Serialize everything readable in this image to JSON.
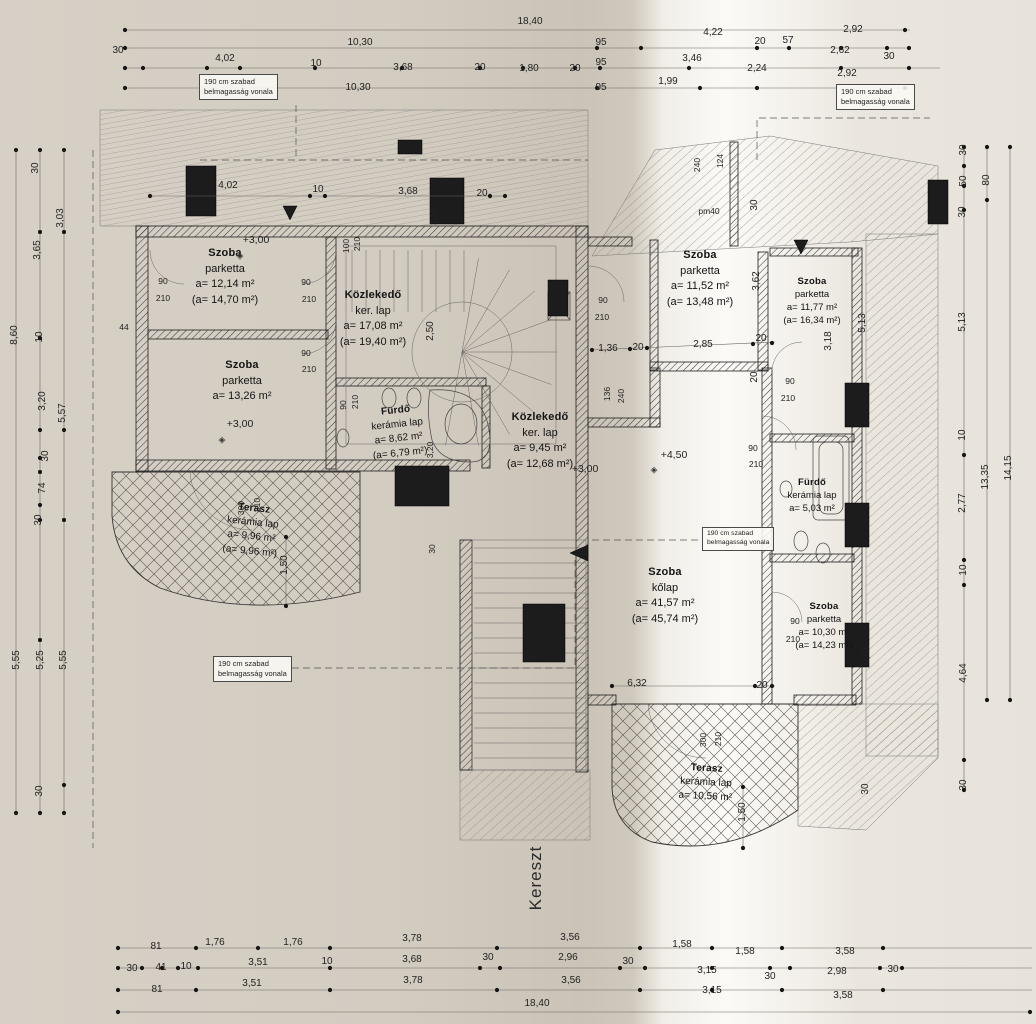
{
  "page": {
    "axis_label": "Kereszt",
    "note_line1": "190 cm szabad",
    "note_line2": "belmagasság vonala"
  },
  "rooms": [
    {
      "lines": [
        "Szoba",
        "parketta",
        "a= 12,14 m²",
        "(a= 14,70 m²)"
      ]
    },
    {
      "lines": [
        "Szoba",
        "parketta",
        "a= 13,26 m²",
        ""
      ]
    },
    {
      "lines": [
        "Közlekedő",
        "ker. lap",
        "a= 17,08 m²",
        "(a= 19,40 m²)"
      ]
    },
    {
      "lines": [
        "Fürdő",
        "kerámia lap",
        "a= 8,62 m²",
        "(a= 6,79 m²)"
      ]
    },
    {
      "lines": [
        "Közlekedő",
        "ker. lap",
        "a= 9,45 m²",
        "(a= 12,68 m²)"
      ]
    },
    {
      "lines": [
        "Szoba",
        "kőlap",
        "a= 41,57 m²",
        "(a= 45,74 m²)"
      ]
    },
    {
      "lines": [
        "Szoba",
        "parketta",
        "a= 11,52 m²",
        "(a= 13,48 m²)"
      ]
    },
    {
      "lines": [
        "Szoba",
        "parketta",
        "a= 11,77 m²",
        "(a= 16,34 m²)"
      ]
    },
    {
      "lines": [
        "Fürdő",
        "kerámia lap",
        "a= 5,03 m²",
        ""
      ]
    },
    {
      "lines": [
        "Szoba",
        "parketta",
        "a= 10,30 m²",
        "(a= 14,23 m²)"
      ]
    },
    {
      "lines": [
        "Terasz",
        "kerámia lap",
        "a= 9,96 m²",
        "(a= 9,96 m²)"
      ]
    },
    {
      "lines": [
        "Terasz",
        "kerámia lap",
        "a= 10,56 m²",
        ""
      ]
    }
  ],
  "annotations": [
    {
      "t": "18,40",
      "x": 530,
      "y": 22
    },
    {
      "t": "10,30",
      "x": 360,
      "y": 43
    },
    {
      "t": "4,22",
      "x": 713,
      "y": 33
    },
    {
      "t": "2,92",
      "x": 853,
      "y": 30
    },
    {
      "t": "95",
      "x": 601,
      "y": 43
    },
    {
      "t": "20",
      "x": 760,
      "y": 42
    },
    {
      "t": "57",
      "x": 788,
      "y": 41
    },
    {
      "t": "2,62",
      "x": 840,
      "y": 51
    },
    {
      "t": "30",
      "x": 889,
      "y": 57
    },
    {
      "t": "30",
      "x": 118,
      "y": 51
    },
    {
      "t": "4,02",
      "x": 225,
      "y": 59
    },
    {
      "t": "10",
      "x": 316,
      "y": 64
    },
    {
      "t": "3,68",
      "x": 403,
      "y": 68
    },
    {
      "t": "20",
      "x": 480,
      "y": 68
    },
    {
      "t": "1,80",
      "x": 529,
      "y": 69
    },
    {
      "t": "20",
      "x": 575,
      "y": 69
    },
    {
      "t": "95",
      "x": 601,
      "y": 63
    },
    {
      "t": "3,46",
      "x": 692,
      "y": 59
    },
    {
      "t": "2,24",
      "x": 757,
      "y": 69
    },
    {
      "t": "2,92",
      "x": 847,
      "y": 74
    },
    {
      "t": "95",
      "x": 601,
      "y": 88
    },
    {
      "t": "1,99",
      "x": 668,
      "y": 82
    },
    {
      "t": "10,30",
      "x": 358,
      "y": 88
    },
    {
      "t": "4,02",
      "x": 228,
      "y": 186
    },
    {
      "t": "10",
      "x": 318,
      "y": 190
    },
    {
      "t": "3,68",
      "x": 408,
      "y": 192
    },
    {
      "t": "20",
      "x": 482,
      "y": 194
    },
    {
      "t": "8,60",
      "x": 15,
      "y": 335,
      "v": 1
    },
    {
      "t": "30",
      "x": 36,
      "y": 168,
      "v": 1
    },
    {
      "t": "3,65",
      "x": 38,
      "y": 250,
      "v": 1
    },
    {
      "t": "10",
      "x": 40,
      "y": 337,
      "v": 1
    },
    {
      "t": "3,20",
      "x": 43,
      "y": 401,
      "v": 1
    },
    {
      "t": "30",
      "x": 46,
      "y": 456,
      "v": 1
    },
    {
      "t": "74",
      "x": 43,
      "y": 488,
      "v": 1
    },
    {
      "t": "30",
      "x": 39,
      "y": 520,
      "v": 1
    },
    {
      "t": "3,03",
      "x": 61,
      "y": 218,
      "v": 1
    },
    {
      "t": "5,57",
      "x": 63,
      "y": 413,
      "v": 1
    },
    {
      "t": "5,55",
      "x": 17,
      "y": 660,
      "v": 1
    },
    {
      "t": "5,25",
      "x": 41,
      "y": 660,
      "v": 1
    },
    {
      "t": "5,55",
      "x": 64,
      "y": 660,
      "v": 1
    },
    {
      "t": "30",
      "x": 40,
      "y": 791,
      "v": 1
    },
    {
      "t": "30",
      "x": 964,
      "y": 150,
      "v": 1
    },
    {
      "t": "50",
      "x": 964,
      "y": 181,
      "v": 1
    },
    {
      "t": "30",
      "x": 963,
      "y": 212,
      "v": 1
    },
    {
      "t": "80",
      "x": 987,
      "y": 180,
      "v": 1
    },
    {
      "t": "5,13",
      "x": 963,
      "y": 322,
      "v": 1
    },
    {
      "t": "10",
      "x": 963,
      "y": 435,
      "v": 1
    },
    {
      "t": "2,77",
      "x": 963,
      "y": 503,
      "v": 1
    },
    {
      "t": "13,35",
      "x": 986,
      "y": 477,
      "v": 1
    },
    {
      "t": "14,15",
      "x": 1009,
      "y": 468,
      "v": 1
    },
    {
      "t": "10",
      "x": 964,
      "y": 570,
      "v": 1
    },
    {
      "t": "4,64",
      "x": 964,
      "y": 673,
      "v": 1
    },
    {
      "t": "30",
      "x": 964,
      "y": 785,
      "v": 1
    },
    {
      "t": "5,13",
      "x": 863,
      "y": 323,
      "v": 1
    },
    {
      "t": "3,18",
      "x": 829,
      "y": 341,
      "v": 1
    },
    {
      "t": "3,62",
      "x": 757,
      "y": 281,
      "v": 1
    },
    {
      "t": "30",
      "x": 755,
      "y": 205,
      "v": 1
    },
    {
      "t": "240",
      "x": 697,
      "y": 165,
      "v": 1,
      "c": "sm"
    },
    {
      "t": "124",
      "x": 720,
      "y": 161,
      "v": 1,
      "c": "sm"
    },
    {
      "t": "20",
      "x": 755,
      "y": 377,
      "v": 1
    },
    {
      "t": "4,64",
      "x": 867,
      "y": 655,
      "v": 1
    },
    {
      "t": "30",
      "x": 866,
      "y": 789,
      "v": 1
    },
    {
      "t": "pm40",
      "x": 709,
      "y": 211,
      "c": "sm"
    },
    {
      "t": "1,36",
      "x": 608,
      "y": 349
    },
    {
      "t": "20",
      "x": 638,
      "y": 348
    },
    {
      "t": "2,85",
      "x": 703,
      "y": 345
    },
    {
      "t": "20",
      "x": 761,
      "y": 339
    },
    {
      "t": "6,32",
      "x": 637,
      "y": 684
    },
    {
      "t": "20",
      "x": 762,
      "y": 686
    },
    {
      "t": "44",
      "x": 124,
      "y": 327,
      "c": "sm"
    },
    {
      "t": "100",
      "x": 346,
      "y": 246,
      "v": 1,
      "c": "sm"
    },
    {
      "t": "210",
      "x": 357,
      "y": 244,
      "v": 1,
      "c": "sm"
    },
    {
      "t": "1,10",
      "x": 433,
      "y": 217,
      "v": 1,
      "c": "sm"
    },
    {
      "t": "2,50",
      "x": 431,
      "y": 331,
      "v": 1
    },
    {
      "t": "90",
      "x": 343,
      "y": 405,
      "v": 1,
      "c": "sm"
    },
    {
      "t": "210",
      "x": 355,
      "y": 402,
      "v": 1,
      "c": "sm"
    },
    {
      "t": "3,20",
      "x": 430,
      "y": 450,
      "v": 1,
      "c": "sm"
    },
    {
      "t": "30",
      "x": 432,
      "y": 549,
      "v": 1,
      "c": "sm"
    },
    {
      "t": "136",
      "x": 607,
      "y": 394,
      "v": 1,
      "c": "sm"
    },
    {
      "t": "240",
      "x": 621,
      "y": 396,
      "v": 1,
      "c": "sm"
    },
    {
      "t": "300",
      "x": 241,
      "y": 508,
      "v": 1,
      "c": "sm"
    },
    {
      "t": "210",
      "x": 257,
      "y": 505,
      "v": 1,
      "c": "sm"
    },
    {
      "t": "1,50",
      "x": 285,
      "y": 565,
      "v": 1
    },
    {
      "t": "300",
      "x": 703,
      "y": 740,
      "v": 1,
      "c": "sm"
    },
    {
      "t": "210",
      "x": 718,
      "y": 739,
      "v": 1,
      "c": "sm"
    },
    {
      "t": "1,50",
      "x": 743,
      "y": 812,
      "v": 1
    },
    {
      "t": "90",
      "x": 163,
      "y": 281,
      "c": "sm"
    },
    {
      "t": "210",
      "x": 163,
      "y": 298,
      "c": "sm"
    },
    {
      "t": "90",
      "x": 306,
      "y": 282,
      "c": "sm"
    },
    {
      "t": "210",
      "x": 309,
      "y": 299,
      "c": "sm"
    },
    {
      "t": "90",
      "x": 306,
      "y": 353,
      "c": "sm"
    },
    {
      "t": "210",
      "x": 309,
      "y": 369,
      "c": "sm"
    },
    {
      "t": "90",
      "x": 603,
      "y": 300,
      "c": "sm"
    },
    {
      "t": "210",
      "x": 602,
      "y": 317,
      "c": "sm"
    },
    {
      "t": "90",
      "x": 753,
      "y": 448,
      "c": "sm"
    },
    {
      "t": "210",
      "x": 756,
      "y": 464,
      "c": "sm"
    },
    {
      "t": "90",
      "x": 790,
      "y": 381,
      "c": "sm"
    },
    {
      "t": "210",
      "x": 788,
      "y": 398,
      "c": "sm"
    },
    {
      "t": "90",
      "x": 795,
      "y": 621,
      "c": "sm"
    },
    {
      "t": "210",
      "x": 793,
      "y": 639,
      "c": "sm"
    },
    {
      "t": "+3,00",
      "x": 256,
      "y": 240,
      "c": "lvl"
    },
    {
      "t": "+3,00",
      "x": 240,
      "y": 424,
      "c": "lvl"
    },
    {
      "t": "+3,00",
      "x": 585,
      "y": 469,
      "c": "lvl"
    },
    {
      "t": "+4,50",
      "x": 674,
      "y": 455,
      "c": "lvl"
    },
    {
      "t": "◈",
      "x": 240,
      "y": 256,
      "c": "mark",
      "n": "level-mark-icon"
    },
    {
      "t": "◈",
      "x": 222,
      "y": 440,
      "c": "mark",
      "n": "level-mark-icon"
    },
    {
      "t": "◈",
      "x": 654,
      "y": 470,
      "c": "mark",
      "n": "level-mark-icon"
    },
    {
      "t": "81",
      "x": 156,
      "y": 947
    },
    {
      "t": "1,76",
      "x": 215,
      "y": 943
    },
    {
      "t": "1,76",
      "x": 293,
      "y": 943
    },
    {
      "t": "3,78",
      "x": 412,
      "y": 939
    },
    {
      "t": "3,56",
      "x": 570,
      "y": 938
    },
    {
      "t": "1,58",
      "x": 682,
      "y": 945
    },
    {
      "t": "1,58",
      "x": 745,
      "y": 952
    },
    {
      "t": "3,58",
      "x": 845,
      "y": 952
    },
    {
      "t": "30",
      "x": 132,
      "y": 969
    },
    {
      "t": "41",
      "x": 161,
      "y": 968
    },
    {
      "t": "10",
      "x": 186,
      "y": 967
    },
    {
      "t": "3,51",
      "x": 258,
      "y": 963
    },
    {
      "t": "10",
      "x": 327,
      "y": 962
    },
    {
      "t": "3,68",
      "x": 412,
      "y": 960
    },
    {
      "t": "30",
      "x": 488,
      "y": 958
    },
    {
      "t": "2,96",
      "x": 568,
      "y": 958
    },
    {
      "t": "30",
      "x": 628,
      "y": 962
    },
    {
      "t": "3,15",
      "x": 707,
      "y": 971
    },
    {
      "t": "30",
      "x": 770,
      "y": 977
    },
    {
      "t": "2,98",
      "x": 837,
      "y": 972
    },
    {
      "t": "30",
      "x": 893,
      "y": 970
    },
    {
      "t": "81",
      "x": 157,
      "y": 990
    },
    {
      "t": "3,51",
      "x": 252,
      "y": 984
    },
    {
      "t": "3,78",
      "x": 413,
      "y": 981
    },
    {
      "t": "3,56",
      "x": 571,
      "y": 981
    },
    {
      "t": "3,15",
      "x": 712,
      "y": 991
    },
    {
      "t": "3,58",
      "x": 843,
      "y": 996
    },
    {
      "t": "18,40",
      "x": 537,
      "y": 1004
    }
  ]
}
